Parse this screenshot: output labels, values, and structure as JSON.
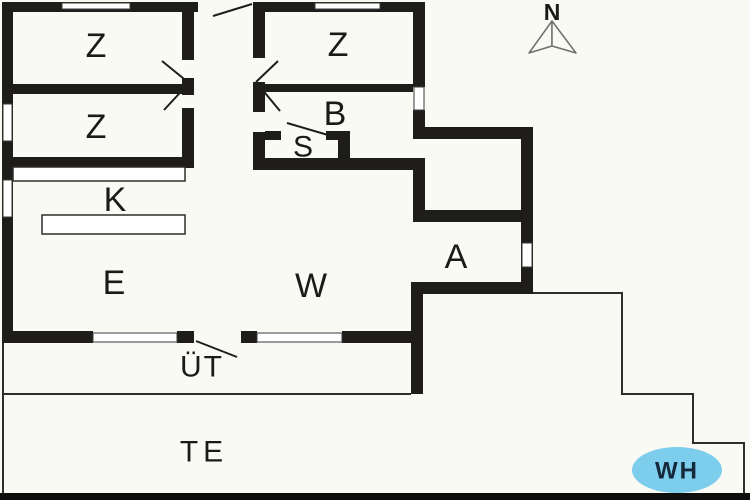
{
  "meta": {
    "title": "Holiday house floor plan",
    "canvas_w": 750,
    "canvas_h": 500
  },
  "colors": {
    "background": "#FAFAF5",
    "wall": "#1e1d1b",
    "window_fill": "#ffffff",
    "window_stroke": "#3a3a38",
    "thin_line": "#2e2d2b",
    "door_line": "#1e1d1b",
    "label": "#1a1a18",
    "bottom_bar": "#0e0e0c",
    "wh_fill": "#7dcdec",
    "wh_text": "#15293d",
    "compass_stroke": "#6f6f6d"
  },
  "rooms": [
    {
      "name": "room-label-bedroom-1",
      "label": "Z",
      "x": 96,
      "y": 46,
      "size": 34,
      "spacing": 0
    },
    {
      "name": "room-label-bedroom-2",
      "label": "Z",
      "x": 96,
      "y": 127,
      "size": 34,
      "spacing": 0
    },
    {
      "name": "room-label-bedroom-3",
      "label": "Z",
      "x": 338,
      "y": 45,
      "size": 34,
      "spacing": 0
    },
    {
      "name": "room-label-bathroom",
      "label": "B",
      "x": 335,
      "y": 114,
      "size": 34,
      "spacing": 0
    },
    {
      "name": "room-label-sauna",
      "label": "S",
      "x": 303,
      "y": 147,
      "size": 30,
      "spacing": 0
    },
    {
      "name": "room-label-kitchen",
      "label": "K",
      "x": 115,
      "y": 200,
      "size": 34,
      "spacing": 0
    },
    {
      "name": "room-label-dining",
      "label": "E",
      "x": 114,
      "y": 283,
      "size": 34,
      "spacing": 0
    },
    {
      "name": "room-label-living",
      "label": "W",
      "x": 311,
      "y": 286,
      "size": 34,
      "spacing": 0
    },
    {
      "name": "room-label-annex",
      "label": "A",
      "x": 456,
      "y": 257,
      "size": 34,
      "spacing": 0
    },
    {
      "name": "room-label-covered-terrace",
      "label": "ÜT",
      "x": 202,
      "y": 367,
      "size": 30,
      "spacing": 2
    },
    {
      "name": "room-label-terrace",
      "label": "TE",
      "x": 204,
      "y": 452,
      "size": 30,
      "spacing": 5
    }
  ],
  "wh_badge": {
    "label": "WH",
    "cx": 677,
    "cy": 470,
    "rx": 45,
    "ry": 23,
    "font_size": 24,
    "spacing": 2
  },
  "compass": {
    "label": "N",
    "label_x": 552,
    "label_y": 12,
    "font_size": 23,
    "apex": [
      552,
      21
    ],
    "left_tip": [
      529,
      53
    ],
    "right_tip": [
      576,
      53
    ],
    "mid": [
      552,
      46
    ]
  },
  "walls": [
    {
      "name": "wall-top-left",
      "x": 2,
      "y": 2,
      "w": 196,
      "h": 10
    },
    {
      "name": "wall-top-right",
      "x": 253,
      "y": 2,
      "w": 172,
      "h": 10
    },
    {
      "name": "wall-left",
      "x": 2,
      "y": 2,
      "w": 11,
      "h": 341
    },
    {
      "name": "wall-bottom-seg1",
      "x": 2,
      "y": 331,
      "w": 91,
      "h": 12
    },
    {
      "name": "wall-bottom-seg2",
      "x": 177,
      "y": 331,
      "w": 17,
      "h": 12
    },
    {
      "name": "wall-bottom-seg3",
      "x": 241,
      "y": 331,
      "w": 16,
      "h": 12
    },
    {
      "name": "wall-bottom-seg4",
      "x": 342,
      "y": 331,
      "w": 81,
      "h": 12
    },
    {
      "name": "wall-east-bedroom-upper",
      "x": 413,
      "y": 2,
      "w": 12,
      "h": 85
    },
    {
      "name": "wall-east-bedroom-lower",
      "x": 413,
      "y": 110,
      "w": 12,
      "h": 17
    },
    {
      "name": "wall-annex-top",
      "x": 413,
      "y": 127,
      "w": 120,
      "h": 12
    },
    {
      "name": "wall-annex-east",
      "x": 521,
      "y": 127,
      "w": 12,
      "h": 167
    },
    {
      "name": "wall-annex-inner",
      "x": 413,
      "y": 210,
      "w": 112,
      "h": 12
    },
    {
      "name": "wall-bath-east-stub",
      "x": 413,
      "y": 158,
      "w": 12,
      "h": 64
    },
    {
      "name": "wall-bath-south",
      "x": 253,
      "y": 158,
      "w": 172,
      "h": 12
    },
    {
      "name": "wall-annex-south",
      "x": 411,
      "y": 282,
      "w": 122,
      "h": 12
    },
    {
      "name": "wall-terrace-east",
      "x": 411,
      "y": 282,
      "w": 12,
      "h": 112
    },
    {
      "name": "wall-left-bedrooms-divider",
      "x": 2,
      "y": 84,
      "w": 180,
      "h": 10
    },
    {
      "name": "wall-kitchen-north",
      "x": 2,
      "y": 157,
      "w": 192,
      "h": 11
    },
    {
      "name": "wall-hall-west-a",
      "x": 182,
      "y": 12,
      "w": 12,
      "h": 48
    },
    {
      "name": "wall-hall-west-b",
      "x": 182,
      "y": 78,
      "w": 12,
      "h": 17
    },
    {
      "name": "wall-hall-west-c",
      "x": 182,
      "y": 108,
      "w": 12,
      "h": 60
    },
    {
      "name": "wall-hall-east-a",
      "x": 253,
      "y": 12,
      "w": 12,
      "h": 46
    },
    {
      "name": "wall-hall-east-b",
      "x": 253,
      "y": 82,
      "w": 12,
      "h": 30
    },
    {
      "name": "wall-hall-east-c",
      "x": 253,
      "y": 132,
      "w": 12,
      "h": 38
    },
    {
      "name": "wall-zb-divider",
      "x": 265,
      "y": 84,
      "w": 148,
      "h": 8
    },
    {
      "name": "wall-sauna-north-a",
      "x": 265,
      "y": 131,
      "w": 16,
      "h": 9
    },
    {
      "name": "wall-sauna-north-b",
      "x": 326,
      "y": 131,
      "w": 24,
      "h": 9
    },
    {
      "name": "wall-sauna-east",
      "x": 338,
      "y": 131,
      "w": 12,
      "h": 27
    }
  ],
  "windows": [
    {
      "name": "window-top-left",
      "x": 62,
      "y": 3,
      "w": 68,
      "h": 6
    },
    {
      "name": "window-top-right",
      "x": 315,
      "y": 3,
      "w": 65,
      "h": 6
    },
    {
      "name": "window-left-upper",
      "x": 3,
      "y": 104,
      "w": 9,
      "h": 37
    },
    {
      "name": "window-left-lower",
      "x": 3,
      "y": 180,
      "w": 9,
      "h": 37
    },
    {
      "name": "window-east-bedroom",
      "x": 414,
      "y": 87,
      "w": 10,
      "h": 23
    },
    {
      "name": "window-annex",
      "x": 522,
      "y": 243,
      "w": 10,
      "h": 24
    },
    {
      "name": "window-bottom-left",
      "x": 93,
      "y": 333,
      "w": 84,
      "h": 9
    },
    {
      "name": "window-bottom-right",
      "x": 257,
      "y": 333,
      "w": 85,
      "h": 9
    }
  ],
  "counters": [
    {
      "name": "kitchen-counter-upper",
      "x": 13,
      "y": 167,
      "w": 172,
      "h": 14
    },
    {
      "name": "kitchen-counter-lower",
      "x": 42,
      "y": 215,
      "w": 143,
      "h": 19
    }
  ],
  "door_swings": [
    {
      "name": "door-swing-front-entry",
      "x1": 213,
      "y1": 16,
      "x2": 252,
      "y2": 4
    },
    {
      "name": "door-swing-bedroom-left-upper",
      "x1": 189,
      "y1": 83,
      "x2": 162,
      "y2": 61
    },
    {
      "name": "door-swing-bedroom-left-lower",
      "x1": 189,
      "y1": 83,
      "x2": 164,
      "y2": 110
    },
    {
      "name": "door-swing-bedroom-right",
      "x1": 256,
      "y1": 82,
      "x2": 278,
      "y2": 61
    },
    {
      "name": "door-swing-bathroom",
      "x1": 256,
      "y1": 82,
      "x2": 280,
      "y2": 111
    },
    {
      "name": "door-swing-sauna",
      "x1": 287,
      "y1": 123,
      "x2": 328,
      "y2": 135
    },
    {
      "name": "door-swing-terrace",
      "x1": 196,
      "y1": 341,
      "x2": 237,
      "y2": 357
    }
  ],
  "outlines": [
    {
      "name": "terrace-left-edge",
      "points": [
        [
          3,
          343
        ],
        [
          3,
          493
        ]
      ]
    },
    {
      "name": "covered-terrace-bottom-edge",
      "points": [
        [
          3,
          394
        ],
        [
          411,
          394
        ]
      ]
    },
    {
      "name": "terrace-steps-edge",
      "points": [
        [
          533,
          293
        ],
        [
          622,
          293
        ],
        [
          622,
          394
        ],
        [
          693,
          394
        ],
        [
          693,
          443
        ],
        [
          744,
          443
        ],
        [
          744,
          493
        ]
      ]
    }
  ],
  "bottom_bar": {
    "x": 0,
    "y": 493,
    "w": 750,
    "h": 7
  }
}
